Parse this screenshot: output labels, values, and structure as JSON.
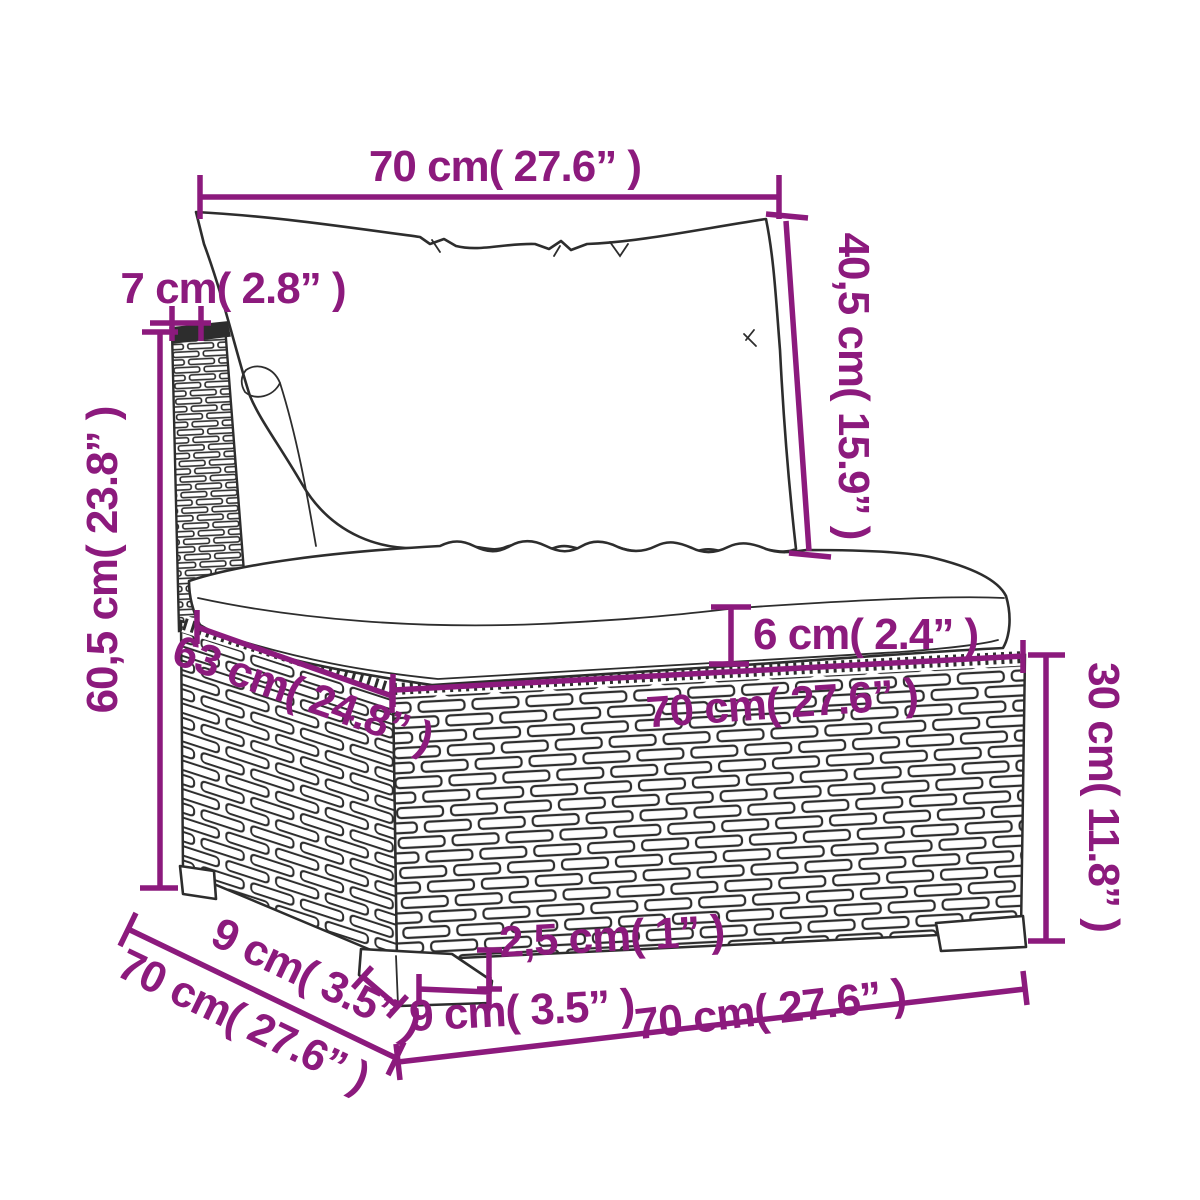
{
  "figure": {
    "description": "Line-art dimension diagram of a poly rattan garden sofa middle section with back cushion and seat cushion",
    "parts": [
      "back-cushion",
      "backrest-post",
      "seat-cushion",
      "rattan-base",
      "back-left-leg",
      "front-left-leg",
      "front-right-leg"
    ]
  },
  "colors": {
    "dimension_accent": "#8C1A7D",
    "linework": "#2D2D2D",
    "background": "#FFFFFF"
  },
  "dimensions": {
    "back_cushion_width": "70 cm( 27.6” )",
    "backrest_depth": "7 cm( 2.8” )",
    "back_cushion_height": "40,5 cm( 15.9” )",
    "seat_back_height": "60,5 cm( 23.8” )",
    "seat_cushion_thickness": "6 cm( 2.4” )",
    "seat_front_width": "70 cm( 27.6” )",
    "base_top_depth": "63 cm( 24.8” )",
    "base_height": "30 cm( 11.8” )",
    "leg_height": "2,5 cm( 1” )",
    "leg_front_width": "9 cm( 3.5” )",
    "leg_side_depth": "9 cm( 3.5” )",
    "overall_depth": "70 cm( 27.6” )",
    "overall_width": "70 cm( 27.6” )"
  }
}
